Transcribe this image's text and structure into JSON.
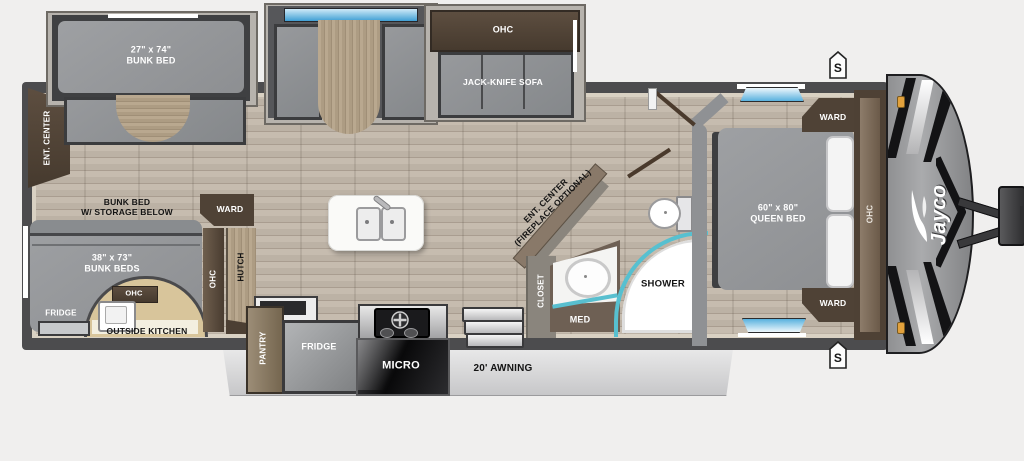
{
  "brand": {
    "logo_text": "Jayco"
  },
  "colors": {
    "wall": "#4c4c4e",
    "floor_wood": "#bdb3a6",
    "cabinet_dark_brown": "#54463a",
    "wood_tan": "#b3a28b",
    "mattress_gray": "#97999c",
    "window_blue": "#58b1de",
    "shower_teal": "#57c0d0",
    "outside_kitchen_tan": "#d8c59b",
    "awning_gray": "#d9d9da",
    "marker_amber": "#e2a13c"
  },
  "slide_outs": {
    "bunk": {
      "size": "27\" x 74\"",
      "name": "BUNK BED"
    },
    "sofa": {
      "ohc": "OHC",
      "name": "JACK-KNIFE SOFA"
    }
  },
  "rear": {
    "ent_center": "ENT. CENTER",
    "bunk_note_line1": "BUNK BED",
    "bunk_note_line2": "W/ STORAGE BELOW",
    "bunk_beds_size": "38\" x 73\"",
    "bunk_beds_name": "BUNK BEDS",
    "outside_kitchen": {
      "fridge": "FRIDGE",
      "ohc": "OHC",
      "label": "OUTSIDE KITCHEN"
    }
  },
  "mid": {
    "ward": "WARD",
    "ohc": "OHC",
    "hutch": "HUTCH",
    "ent_center_line1": "ENT. CENTER",
    "ent_center_line2": "(FIREPLACE OPTIONAL)"
  },
  "kitchen": {
    "pantry": "PANTRY",
    "fridge": "FRIDGE",
    "micro": "MICRO"
  },
  "bath": {
    "closet": "CLOSET",
    "med": "MED",
    "shower": "SHOWER"
  },
  "bedroom": {
    "size": "60\" x 80\"",
    "name": "QUEEN BED",
    "ward_top": "WARD",
    "ward_bottom": "WARD",
    "ohc": "OHC"
  },
  "exterior": {
    "awning": "20' AWNING",
    "speaker_top": "S",
    "speaker_bottom": "S"
  }
}
